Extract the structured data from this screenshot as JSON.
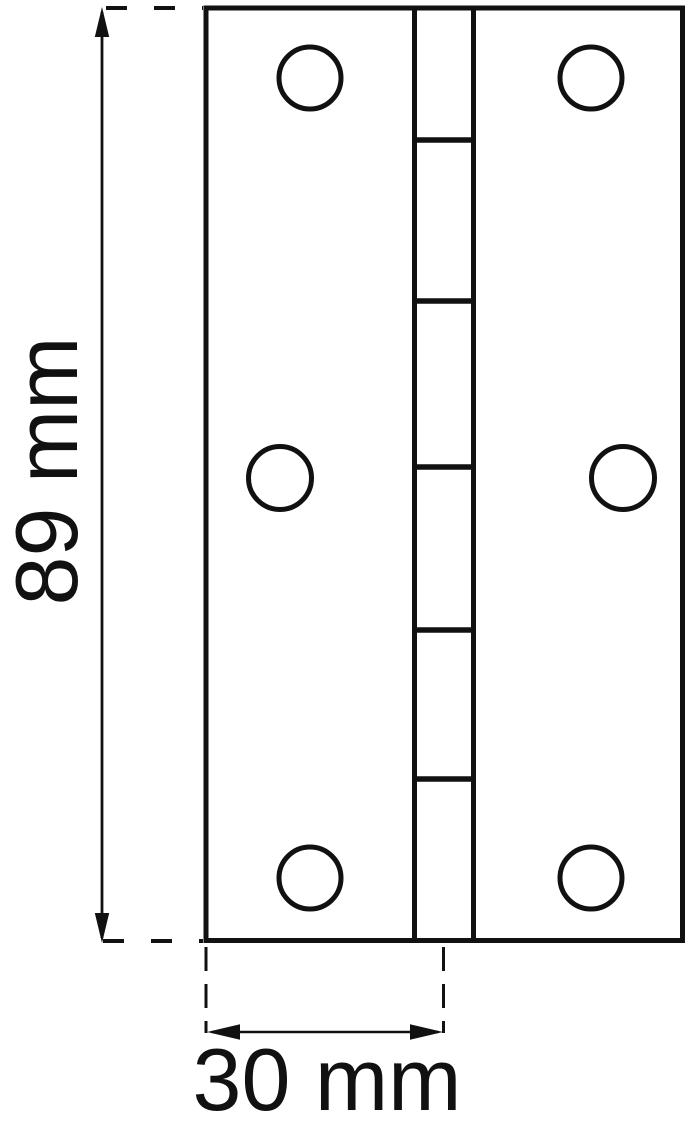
{
  "diagram": {
    "title": "butt-hinge-technical-drawing",
    "product": {
      "type": "hinge",
      "leaves": 2,
      "knuckle_segments": 6,
      "screw_holes": 6
    },
    "dimensions": {
      "height": {
        "value": "89",
        "unit": "mm",
        "label": "89 mm"
      },
      "width": {
        "value": "30",
        "unit": "mm",
        "label": "30 mm"
      }
    },
    "colors": {
      "line": "#111111",
      "background": "#ffffff"
    }
  }
}
